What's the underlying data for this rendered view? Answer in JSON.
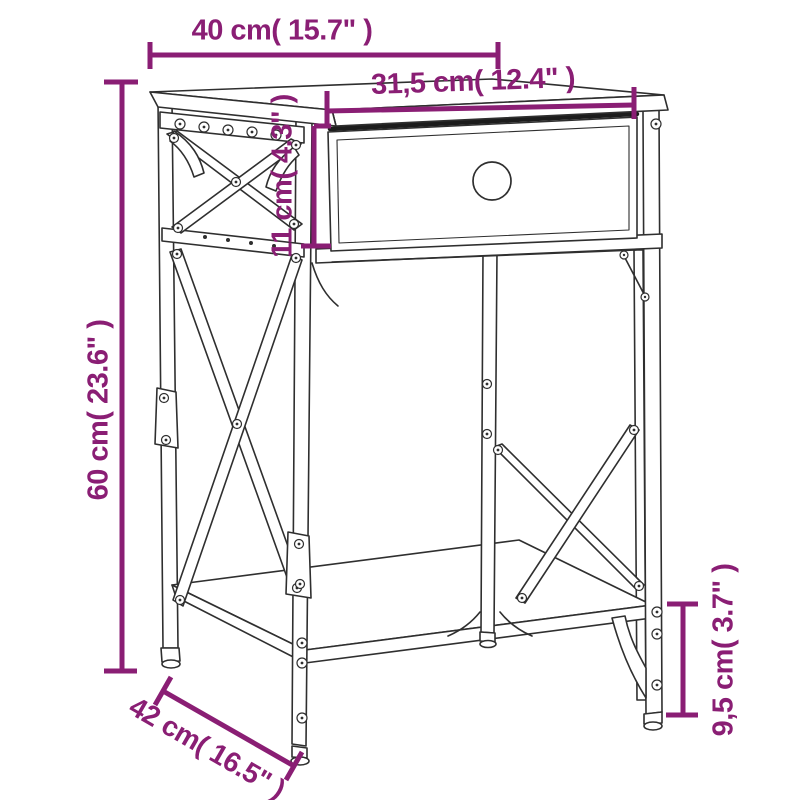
{
  "page": {
    "background": "#ffffff"
  },
  "diagram": {
    "type": "product-dimensions",
    "subject": "nightstand with drawer and lower shelf",
    "colors": {
      "annotation": "#8a1e74",
      "line_art": "#2f2f2f",
      "background": "#ffffff"
    },
    "labels": {
      "top_width": "40 cm( 15.7\" )",
      "drawer_width": "31,5 cm( 12.4\" )",
      "drawer_height": "11 cm( 4.3\" )",
      "total_height": "60 cm( 23.6\" )",
      "depth": "42 cm( 16.5\" )",
      "shelf_clearance": "9,5 cm( 3.7\" )"
    },
    "values": {
      "top_width": {
        "cm": "40",
        "inch": "15.7"
      },
      "drawer_width": {
        "cm": "31,5",
        "inch": "12.4"
      },
      "drawer_height": {
        "cm": "11",
        "inch": "4.3"
      },
      "total_height": {
        "cm": "60",
        "inch": "23.6"
      },
      "depth": {
        "cm": "42",
        "inch": "16.5"
      },
      "shelf_clearance": {
        "cm": "9,5",
        "inch": "3.7"
      }
    }
  }
}
